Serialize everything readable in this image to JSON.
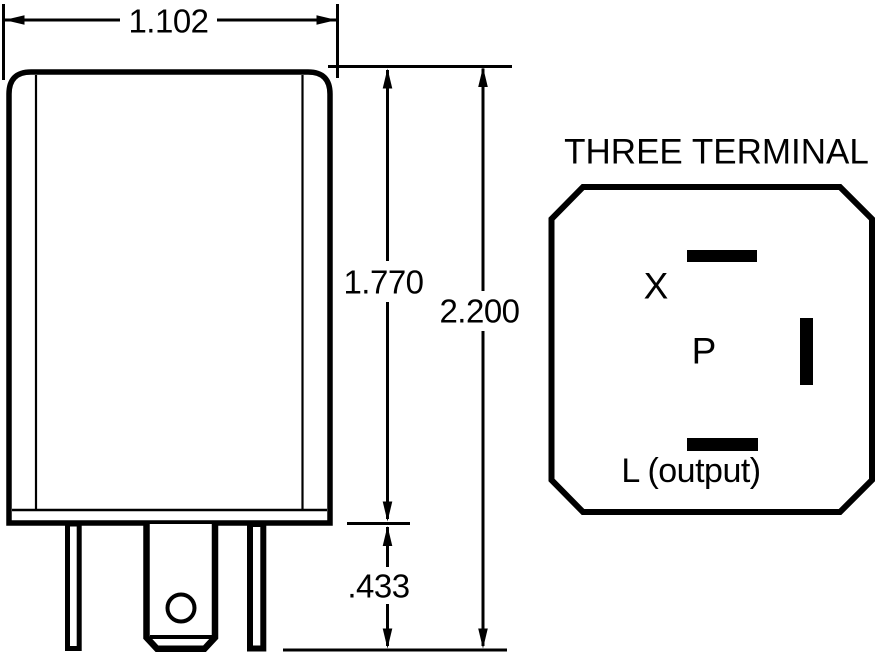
{
  "dimensions": {
    "width_label": "1.102",
    "body_height_label": "1.770",
    "overall_height_label": "2.200",
    "terminal_length_label": ".433"
  },
  "terminal_view": {
    "title": "THREE TERMINAL",
    "terminal_x_label": "X",
    "terminal_p_label": "P",
    "terminal_l_label": "L (output)"
  },
  "colors": {
    "line": "#000000",
    "background": "#ffffff"
  }
}
